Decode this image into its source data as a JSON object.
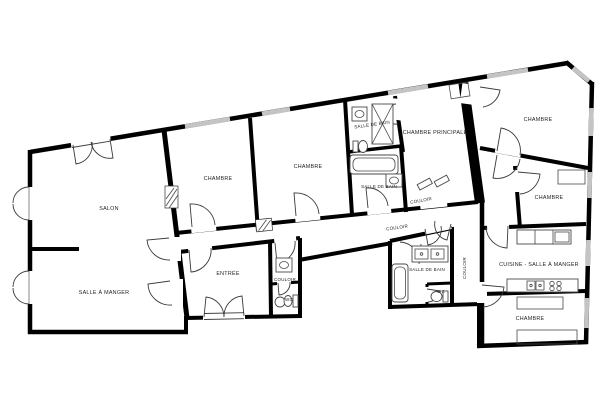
{
  "plan": {
    "background": "#ffffff",
    "colors": {
      "wall": "#000000",
      "window": "#c4c4c4",
      "door_arc": "#3a3a3a",
      "fixture": "#4a4a4a",
      "label": "#1f1f1f"
    },
    "rooms": [
      {
        "id": "salon",
        "label": "SALON"
      },
      {
        "id": "salle-a-manger",
        "label": "SALLE À MANGER"
      },
      {
        "id": "chambre-1",
        "label": "CHAMBRE"
      },
      {
        "id": "chambre-2",
        "label": "CHAMBRE"
      },
      {
        "id": "salle-de-bain-1",
        "label": "SALLE DE BAIN"
      },
      {
        "id": "chambre-principale",
        "label": "CHAMBRE PRINCIPALE"
      },
      {
        "id": "chambre-3",
        "label": "CHAMBRE"
      },
      {
        "id": "salle-de-bain-2",
        "label": "SALLE DE BAIN"
      },
      {
        "id": "couloir-1",
        "label": "COULOIR"
      },
      {
        "id": "couloir-2",
        "label": "COULOIR"
      },
      {
        "id": "chambre-4",
        "label": "CHAMBRE"
      },
      {
        "id": "entree",
        "label": "ENTRÉE"
      },
      {
        "id": "couloir-3",
        "label": "COULOIR"
      },
      {
        "id": "wc-1",
        "label": "WC"
      },
      {
        "id": "salle-de-bain-3",
        "label": "SALLE DE BAIN"
      },
      {
        "id": "wc-2",
        "label": "WC"
      },
      {
        "id": "couloir-4",
        "label": "COULOIR"
      },
      {
        "id": "cuisine-salle-a-manger",
        "label": "CUISINE - SALLE À MANGER"
      },
      {
        "id": "chambre-5",
        "label": "CHAMBRE"
      }
    ]
  }
}
